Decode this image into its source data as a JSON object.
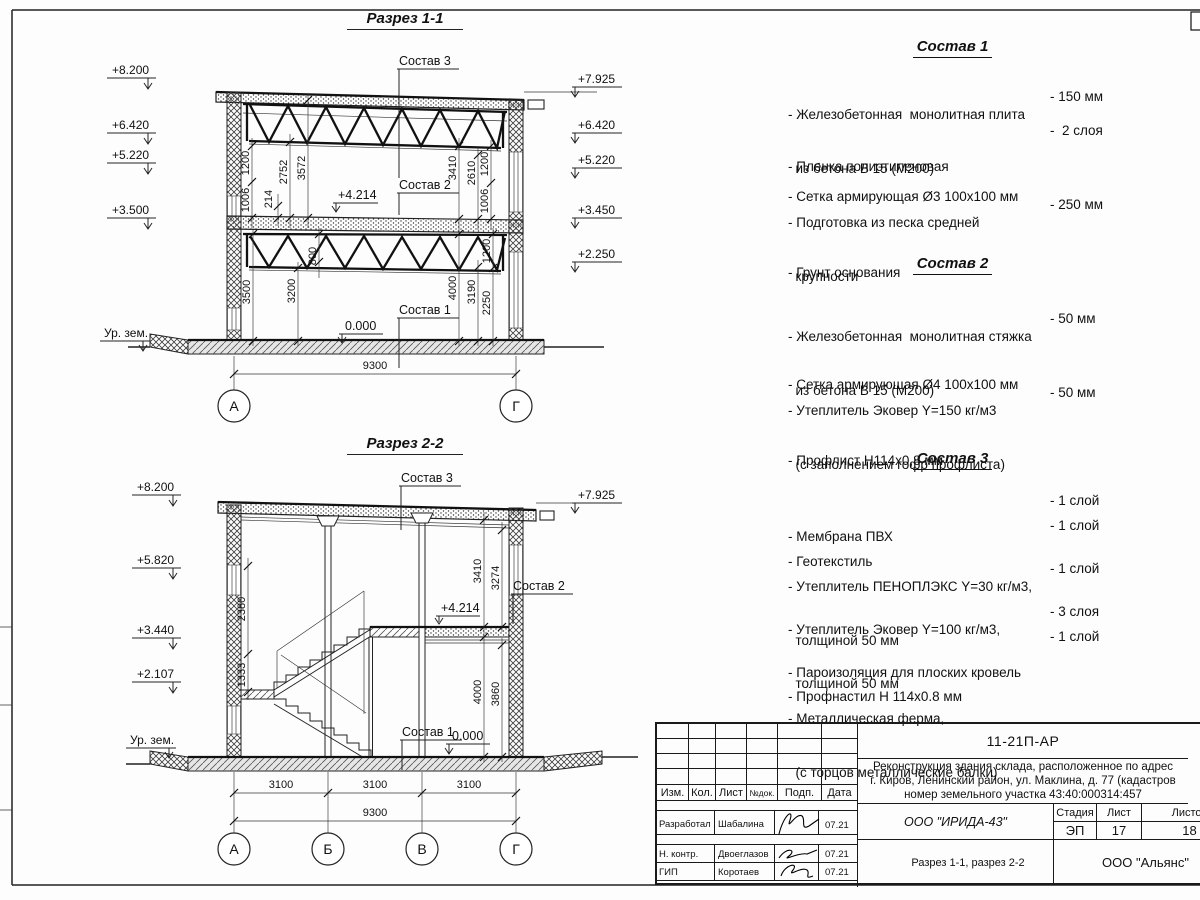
{
  "shared": {
    "ground": "Ур. зем.",
    "l4214": "+4.214",
    "l0": "0.000",
    "c1": "Состав 1",
    "c2": "Состав 2",
    "c3": "Состав 3"
  },
  "section1": {
    "title": "Разрез 1-1",
    "elev_left": [
      "+8.200",
      "+6.420",
      "+5.220",
      "+3.500"
    ],
    "elev_right": [
      "+7.925",
      "+6.420",
      "+5.220",
      "+3.450",
      "+2.250"
    ],
    "dims_left": [
      "1200",
      "1006",
      "214",
      "2752",
      "3572",
      "800",
      "3500",
      "3200"
    ],
    "dims_right": [
      "3410",
      "2610",
      "1200",
      "1006",
      "4000",
      "3190",
      "1200",
      "2250"
    ],
    "dim_width": "9300",
    "axes": [
      "А",
      "Г"
    ]
  },
  "section2": {
    "title": "Разрез 2-2",
    "elev_left": [
      "+8.200",
      "+5.820",
      "+3.440",
      "+2.107"
    ],
    "elev_right": [
      "+7.925"
    ],
    "dims_left": [
      "2380",
      "1333"
    ],
    "dims_right": [
      "3410",
      "3274",
      "4000",
      "3860"
    ],
    "dims_bottom": [
      "3100",
      "3100",
      "3100"
    ],
    "dim_width": "9300",
    "axes": [
      "А",
      "Б",
      "В",
      "Г"
    ]
  },
  "compositions": [
    {
      "title": "Состав 1",
      "items": [
        {
          "line1": "- Железобетонная  монолитная плита",
          "line2": "  из бетона В 15 (М200)",
          "value": "- 150 мм"
        },
        {
          "line1": "- Пленка полиэтиленовая",
          "value": "-  2 слоя"
        },
        {
          "line1": "- Сетка армирующая Ø3 100х100 мм",
          "value": ""
        },
        {
          "line1": "- Подготовка из песка средней",
          "line2": "  крупности",
          "value": "- 250 мм"
        },
        {
          "line1": "- Грунт основания",
          "value": ""
        }
      ]
    },
    {
      "title": "Состав 2",
      "items": [
        {
          "line1": "- Железобетонная  монолитная стяжка",
          "line2": "  из бетона В 15 (М200)",
          "value": "- 50 мм"
        },
        {
          "line1": "- Сетка армирующая Ø4 100х100 мм",
          "value": ""
        },
        {
          "line1": "- Утеплитель Эковер Y=150 кг/м3",
          "line2": "  (с заполнением гофр профлиста)",
          "value": "- 50 мм"
        },
        {
          "line1": "- Профлист Н114х0,8 мм",
          "value": ""
        }
      ]
    },
    {
      "title": "Состав 3",
      "items": [
        {
          "line1": "- Мембрана ПВХ",
          "value": "- 1 слой"
        },
        {
          "line1": "- Геотекстиль",
          "value": "- 1 слой"
        },
        {
          "line1": "- Утеплитель ПЕНОПЛЭКС Y=30 кг/м3,",
          "line2": "  толщиной 50 мм",
          "value": "- 1 слой"
        },
        {
          "line1": "- Утеплитель Эковер Y=100 кг/м3,",
          "line2": "  толщиной 50 мм",
          "value": "- 3 слоя"
        },
        {
          "line1": "- Пароизоляция для плоских кровель",
          "value": "- 1 слой"
        },
        {
          "line1": "- Профнастил Н 114х0.8 мм",
          "value": ""
        },
        {
          "line1": "- Металлическая ферма,",
          "line2": "  (с торцов металлические балки)",
          "value": ""
        }
      ]
    }
  ],
  "titleblock": {
    "doc_number": "11-21П-АР",
    "project_line1": "Реконструкция здания склада, расположенное по адрес",
    "project_line2": "г. Киров, Ленинский район, ул. Маклина, д. 77 (кадастров",
    "project_line3": "номер земельного участка 43:40:000314:457",
    "col_izm": "Изм.",
    "col_kol": "Кол.",
    "col_list": "Лист",
    "col_ndok": "№док.",
    "col_podp": "Подп.",
    "col_data": "Дата",
    "row1_role": "Разработал",
    "row1_name": "Шабалина",
    "row1_date": "07.21",
    "row2_role": "Н. контр.",
    "row2_name": "Двоеглазов",
    "row2_date": "07.21",
    "row3_role": "ГИП",
    "row3_name": "Коротаев",
    "row3_date": "07.21",
    "org": "ООО \"ИРИДА-43\"",
    "stage_label": "Стадия",
    "sheet_label": "Лист",
    "sheets_label": "Листов",
    "stage": "ЭП",
    "sheet": "17",
    "sheets": "18",
    "sheet_title": "Разрез 1-1, разрез 2-2",
    "company": "ООО \"Альянс\""
  }
}
